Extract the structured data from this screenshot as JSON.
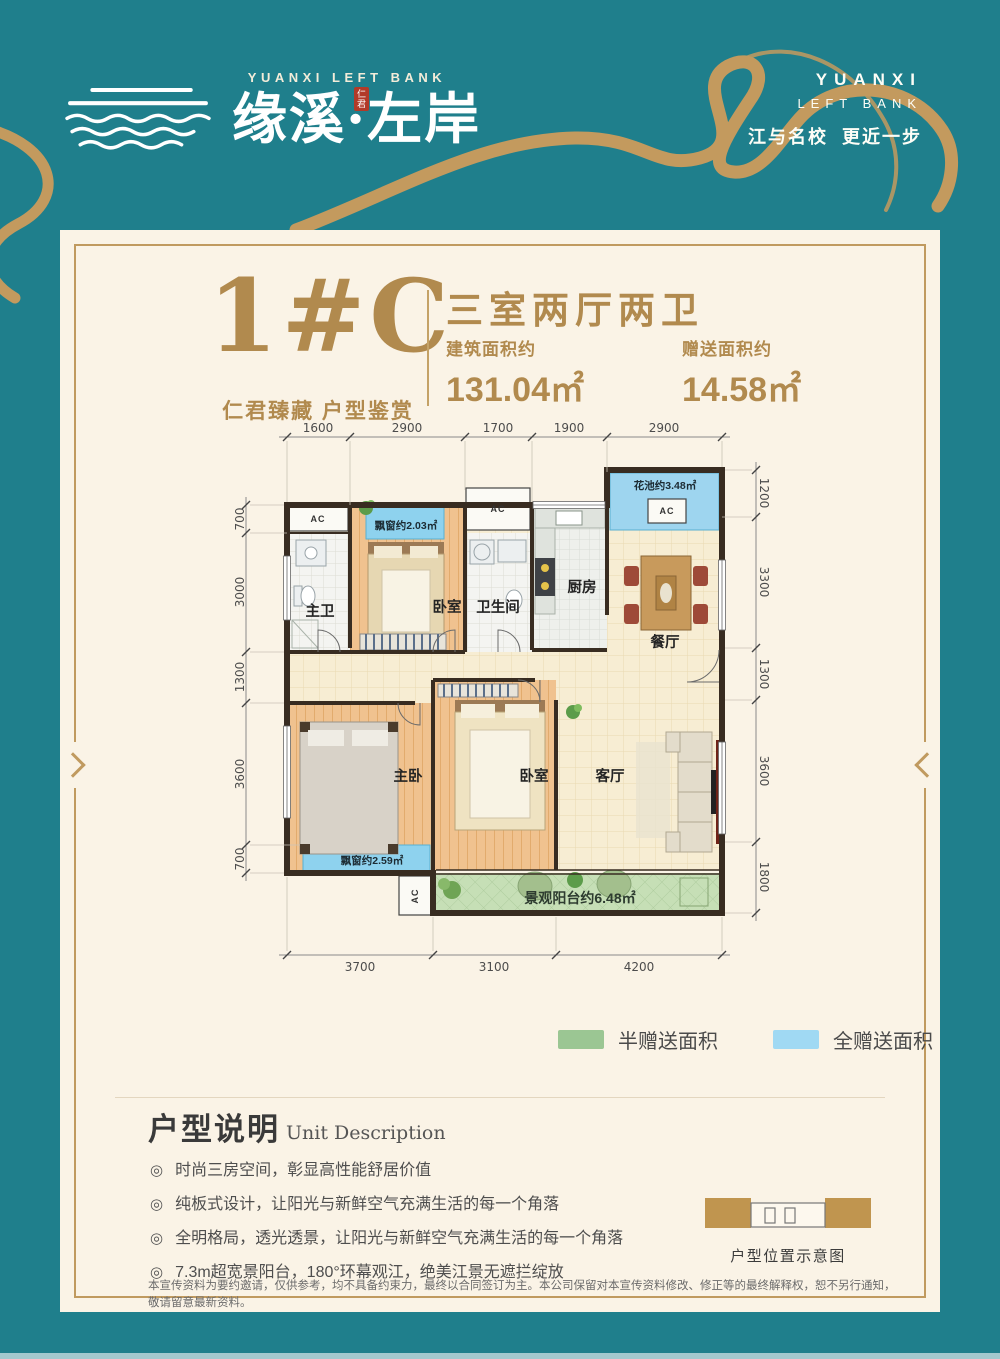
{
  "header": {
    "logo_en": "YUANXI LEFT BANK",
    "logo_cn": "缘溪·左岸",
    "seal": "仁君",
    "right_line1": "YUANXI",
    "right_line2": "LEFT BANK",
    "tagline": "江与名校  更近一步"
  },
  "unit": {
    "name": "1#C",
    "subtitle": "仁君臻藏 户型鉴赏",
    "type": "三室两厅两卫",
    "built_label": "建筑面积约",
    "built_value": "131.04㎡",
    "gift_label": "赠送面积约",
    "gift_value": "14.58㎡"
  },
  "floorplan": {
    "ac": "AC",
    "rooms": {
      "master_bath": "主卫",
      "bedroom_a": "卧室",
      "bathroom": "卫生间",
      "kitchen": "厨房",
      "dining": "餐厅",
      "master_bedroom": "主卧",
      "bedroom_b": "卧室",
      "living": "客厅"
    },
    "areas": {
      "bay_a": "飘窗约2.03㎡",
      "flower_bed": "花池约3.48㎡",
      "bay_b": "飘窗约2.59㎡",
      "balcony": "景观阳台约6.48㎡"
    },
    "dims_top": [
      "1600",
      "2900",
      "1700",
      "1900",
      "2900"
    ],
    "dims_left": [
      "700",
      "3000",
      "1300",
      "3600",
      "700"
    ],
    "dims_right": [
      "1200",
      "3300",
      "1300",
      "3600",
      "1800"
    ],
    "dims_bottom": [
      "3700",
      "3100",
      "4200"
    ]
  },
  "legend": {
    "items": [
      {
        "label": "半赠送面积",
        "color": "#9bc693"
      },
      {
        "label": "全赠送面积",
        "color": "#a0d9f3"
      }
    ]
  },
  "description": {
    "title": "户型说明",
    "title_en": "Unit Description",
    "bullet_icon": "◎",
    "bullets": [
      "时尚三房空间，彰显高性能舒居价值",
      "纯板式设计，让阳光与新鲜空气充满生活的每一个角落",
      "全明格局，透光透景，让阳光与新鲜空气充满生活的每一个角落",
      "7.3m超宽景阳台，180°环幕观江，绝美江景无遮拦绽放"
    ],
    "diagram_label": "户型位置示意图"
  },
  "disclaimer": {
    "text": "本宣传资料为要约邀请，仅供参考，均不具备约束力，最终以合同签订为主。本公司保留对本宣传资料修改、修正等的最终解释权，恕不另行通知，敬请留意最新资料。"
  }
}
